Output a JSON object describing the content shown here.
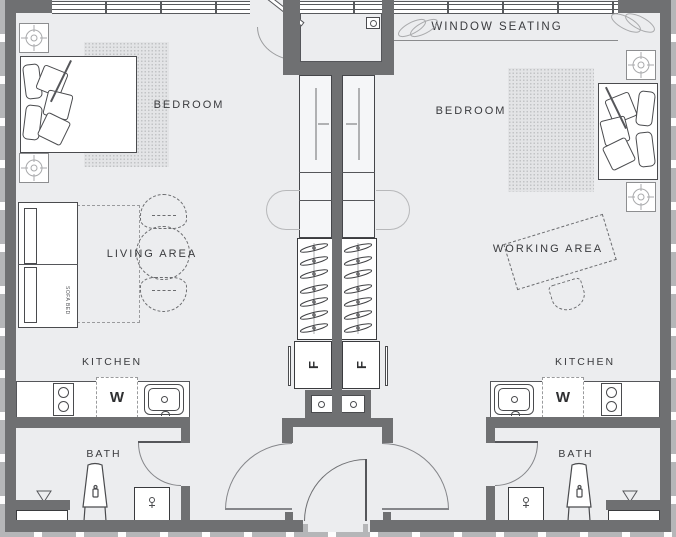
{
  "labels": {
    "window_seating": "WINDOW SEATING",
    "bedroom_left": "BEDROOM",
    "bedroom_right": "BEDROOM",
    "living_area": "LIVING AREA",
    "working_area": "WORKING AREA",
    "kitchen_left": "KITCHEN",
    "kitchen_right": "KITCHEN",
    "bath_left": "BATH",
    "bath_right": "BATH",
    "washer_left": "W",
    "washer_right": "W",
    "fridge_left": "F",
    "fridge_right": "F",
    "sofa_bed": "SOFA BED"
  },
  "colors": {
    "wall_gray": "#6F7072",
    "floor_gray": "#ECEDEF",
    "outline_dark": "#4a4b4e",
    "light_gray": "#b5b6b8",
    "text_gray": "#3a3b3e"
  }
}
